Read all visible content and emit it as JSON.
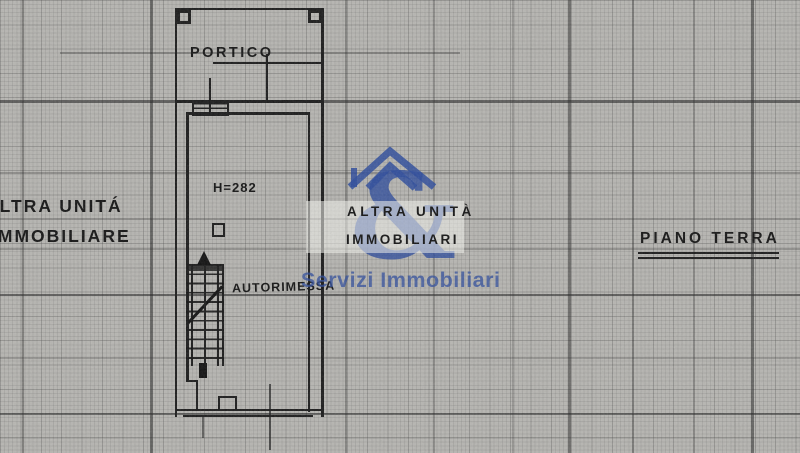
{
  "paper": {
    "background": "#b6b5b1",
    "ink": "#1b1b1b"
  },
  "plan": {
    "labels": {
      "portico": "PORTICO",
      "ceiling_height": "H=282",
      "garage": "AUTORIMESSA"
    }
  },
  "annotations": {
    "left_unit": {
      "line1": "ALTRA UNITÁ",
      "line2": "IMMOBILIARE"
    },
    "center_unit": {
      "line1": "ALTRA UNITÀ",
      "line2": "IMMOBILIARI"
    },
    "floor_level": "PIANO TERRA"
  },
  "watermark": {
    "ampersand": "&",
    "company": "Servizi Immobiliari",
    "icon": "house-roof-icon",
    "blue": "#2d4b9b"
  }
}
